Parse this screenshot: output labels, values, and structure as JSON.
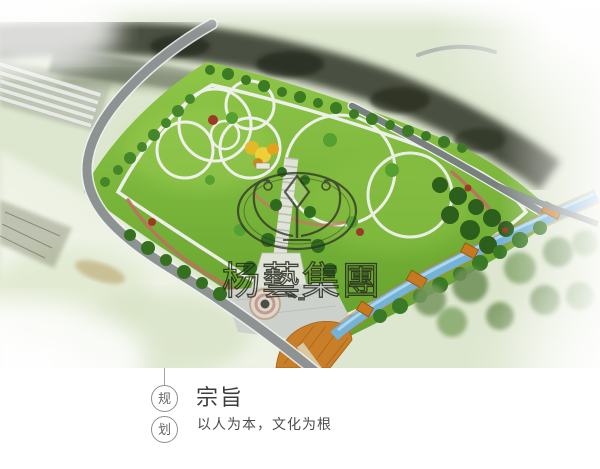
{
  "hero": {
    "watermark_text": "杨藝集團",
    "colors": {
      "lawn": "#78b535",
      "dark_tree_band": "#3a4033",
      "road": "#8d9393",
      "water": "#74b2d8",
      "deck_orange": "#c8781f",
      "path_pink": "#bd7060",
      "haze": "#eef2e8"
    }
  },
  "caption": {
    "badges": [
      "规",
      "划"
    ],
    "title": "宗旨",
    "subtitle": "以人为本，文化为根"
  }
}
